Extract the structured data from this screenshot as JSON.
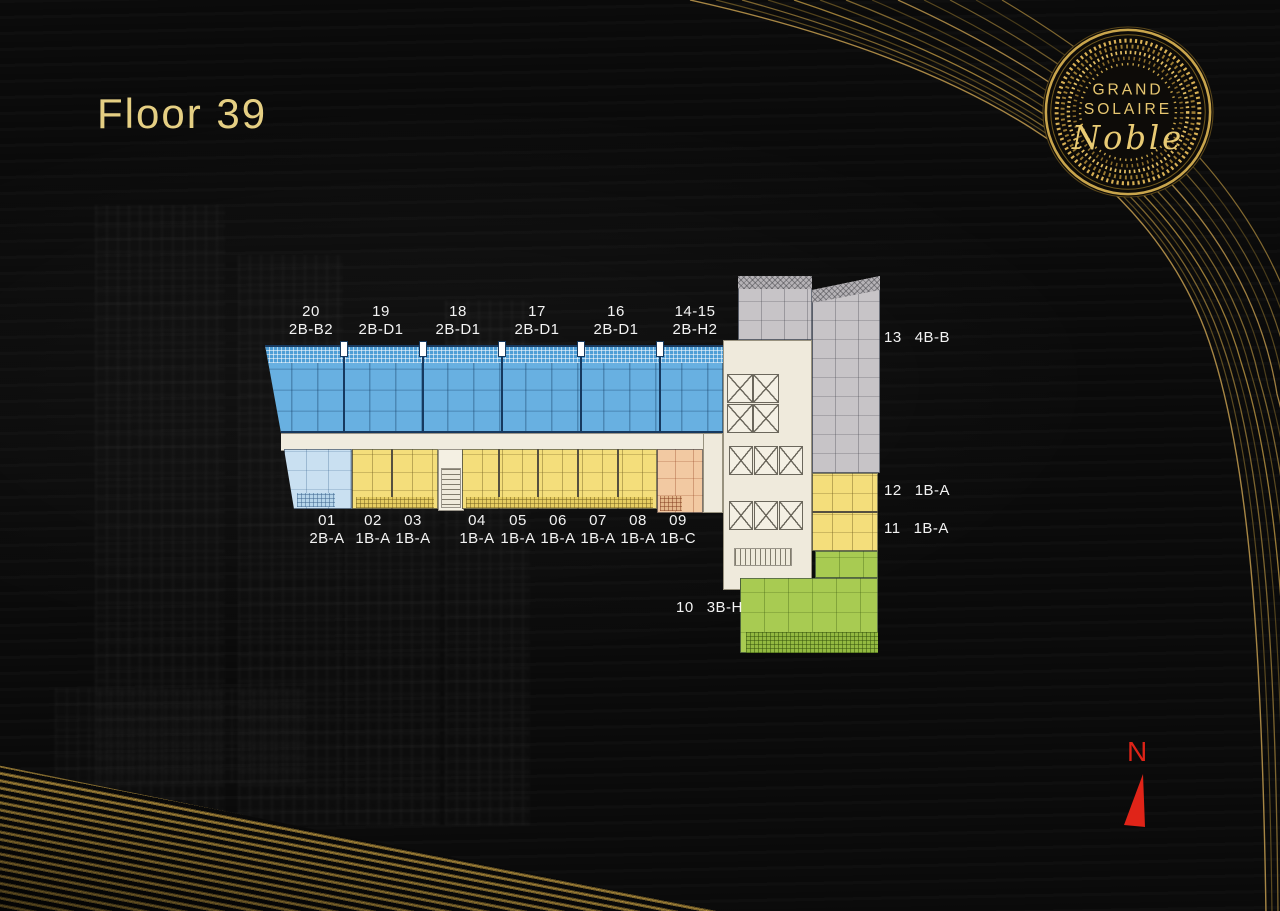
{
  "page": {
    "title": "Floor 39"
  },
  "logo": {
    "brand_line1": "GRAND",
    "brand_line2": "SOLAIRE",
    "brand_script": "Noble"
  },
  "compass": {
    "north_label": "N"
  },
  "floorplan": {
    "top_units": [
      {
        "number": "20",
        "type": "2B-B2"
      },
      {
        "number": "19",
        "type": "2B-D1"
      },
      {
        "number": "18",
        "type": "2B-D1"
      },
      {
        "number": "17",
        "type": "2B-D1"
      },
      {
        "number": "16",
        "type": "2B-D1"
      },
      {
        "number": "14-15",
        "type": "2B-H2"
      }
    ],
    "right_units": [
      {
        "number": "13",
        "type": "4B-B"
      },
      {
        "number": "12",
        "type": "1B-A"
      },
      {
        "number": "11",
        "type": "1B-A"
      }
    ],
    "bottom_units": [
      {
        "number": "01",
        "type": "2B-A"
      },
      {
        "number": "02",
        "type": "1B-A"
      },
      {
        "number": "03",
        "type": "1B-A"
      },
      {
        "number": "04",
        "type": "1B-A"
      },
      {
        "number": "05",
        "type": "1B-A"
      },
      {
        "number": "06",
        "type": "1B-A"
      },
      {
        "number": "07",
        "type": "1B-A"
      },
      {
        "number": "08",
        "type": "1B-A"
      },
      {
        "number": "09",
        "type": "1B-C"
      }
    ],
    "lower_right_unit": {
      "number": "10",
      "type": "3B-H"
    },
    "unit_colors": {
      "two_bed_blue": "#68b0e1",
      "two_bed_light_blue": "#c9e0f1",
      "one_bed_yellow": "#f4de7b",
      "one_bed_c_peach": "#f2c9a2",
      "three_bed_green": "#a8cb52",
      "four_bed_gray": "#c7c4c7",
      "core_beige": "#efeadc"
    },
    "accent_colors": {
      "gold": "#e5cf83",
      "north_red": "#de2317"
    }
  }
}
